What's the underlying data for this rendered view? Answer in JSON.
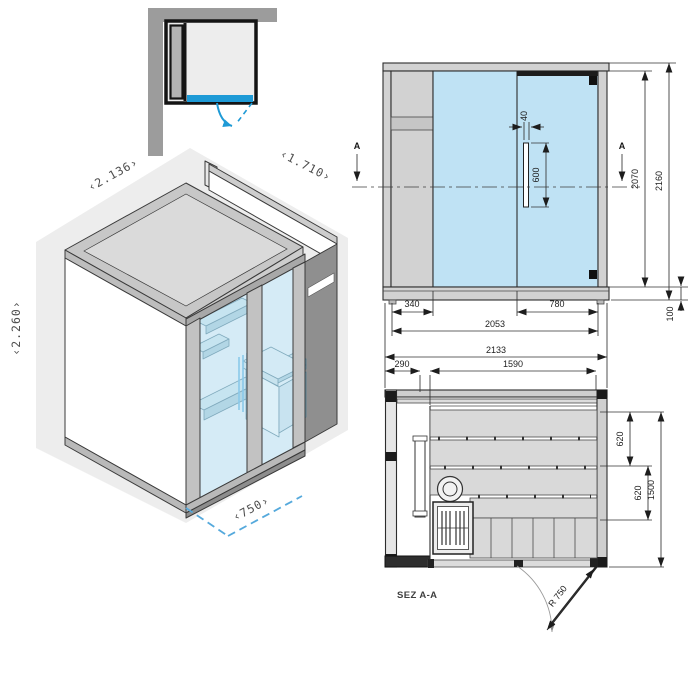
{
  "iso": {
    "width_label": "‹2.136›",
    "depth_label": "‹1.710›",
    "height_label": "‹2.260›",
    "door_width_label": "‹750›"
  },
  "elevation": {
    "section_letter": "A",
    "handle_width": "40",
    "handle_height": "600",
    "inner_height": "2070",
    "overall_height": "2160",
    "base_height": "100",
    "left_panel_width": "340",
    "door_width": "780",
    "inner_width": "2053"
  },
  "shared": {
    "overall_width": "2133"
  },
  "plan": {
    "section_label": "SEZ A-A",
    "front_left_width": "290",
    "bench_length": "1590",
    "bench_depth_upper": "620",
    "bench_depth_lower": "620",
    "inner_depth": "1500",
    "door_swing_radius": "R 750"
  },
  "colors": {
    "accent_blue": "#1e9ad6",
    "dash_blue": "#55a9dc",
    "glass_front": "#bfe2f4",
    "glass_iso": "#bfe2f2",
    "panel_gray": "#d2d2d2",
    "wall_gray": "#9c9c9c",
    "shadow_gray": "#ededed"
  }
}
